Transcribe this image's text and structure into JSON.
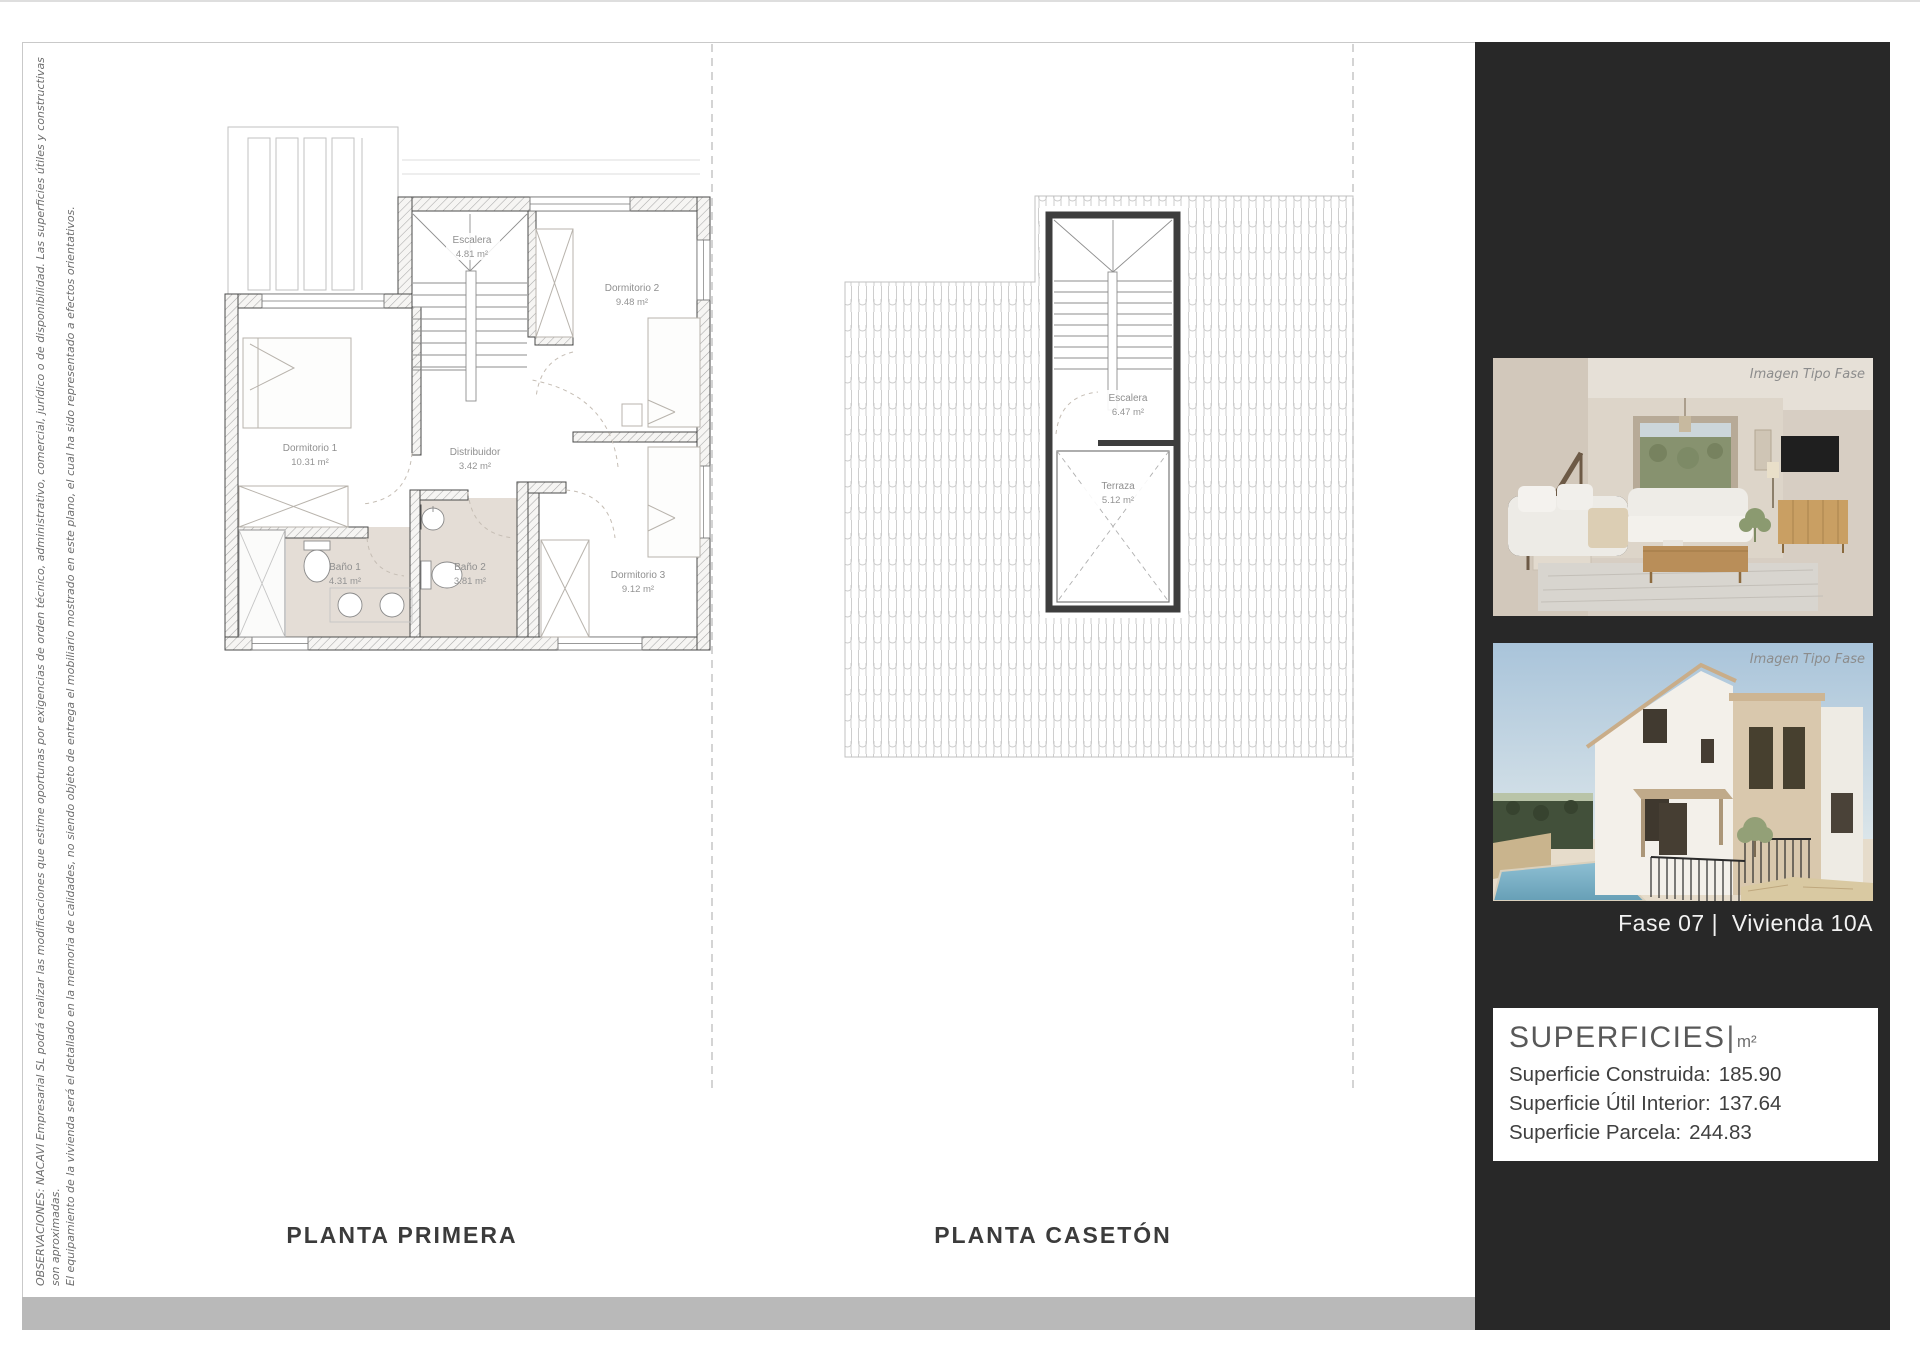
{
  "page": {
    "disclaimer_line1": "OBSERVACIONES: NACAVI Empresarial SL podrá realizar las modificaciones que estime oportunas por exigencias de orden técnico, administrativo, comercial, jurídico o de disponibilidad. Las superficies útiles y constructivas son aproximadas.",
    "disclaimer_line2": "El equipamiento de la vivienda será el detallado en la memoria de calidades, no siendo objeto de entrega el mobiliario mostrado en este plano, el cual ha sido representado a efectos orientativos."
  },
  "plans": {
    "primera": {
      "title": "PLANTA PRIMERA",
      "rooms": {
        "escalera": {
          "name": "Escalera",
          "area": "4.81 m²"
        },
        "dormitorio2": {
          "name": "Dormitorio 2",
          "area": "9.48 m²"
        },
        "dormitorio1": {
          "name": "Dormitorio 1",
          "area": "10.31 m²"
        },
        "distribuidor": {
          "name": "Distribuidor",
          "area": "3.42 m²"
        },
        "bano1": {
          "name": "Baño 1",
          "area": "4.31 m²"
        },
        "bano2": {
          "name": "Baño 2",
          "area": "3.81 m²"
        },
        "dormitorio3": {
          "name": "Dormitorio 3",
          "area": "9.12 m²"
        }
      }
    },
    "caseton": {
      "title": "PLANTA CASETÓN",
      "rooms": {
        "escalera": {
          "name": "Escalera",
          "area": "6.47 m²"
        },
        "terraza": {
          "name": "Terraza",
          "area": "5.12 m²"
        }
      }
    }
  },
  "sidebar": {
    "image1_caption": "Imagen Tipo Fase",
    "image2_caption": "Imagen Tipo Fase",
    "unit_title": "Fase 07 |  Vivienda 10A",
    "superficies": {
      "heading": "SUPERFICIES",
      "separator": "|",
      "unit": "m²",
      "rows": [
        {
          "label": "Superficie Construida:",
          "value": "185.90"
        },
        {
          "label": "Superficie Útil Interior:",
          "value": "137.64"
        },
        {
          "label": "Superficie Parcela:",
          "value": "244.83"
        }
      ]
    }
  },
  "colors": {
    "sidebar_bg": "#282828",
    "bath_floor_fill": "#e4ddd6",
    "bottom_bar": "#b9b9b9",
    "page_bg": "#ffffff"
  }
}
